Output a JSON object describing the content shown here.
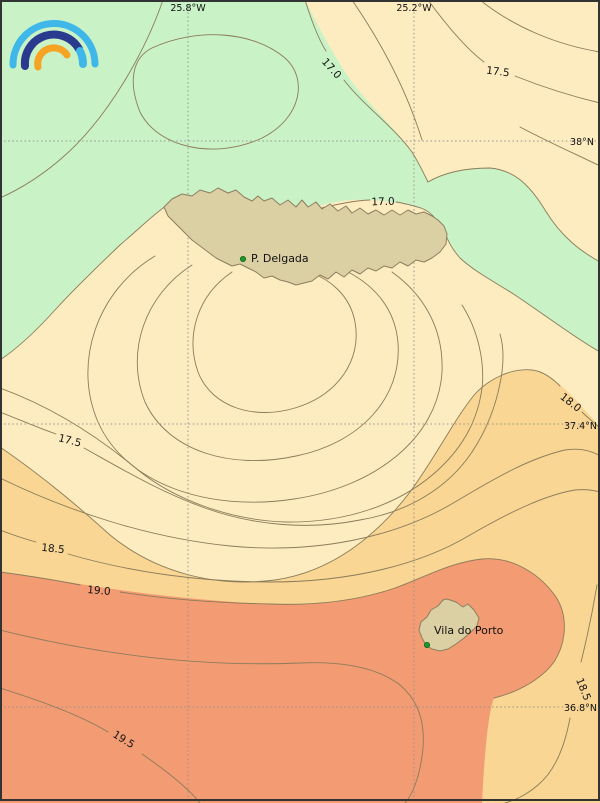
{
  "grid": {
    "lon_labels": [
      "25.8°W",
      "25.2°W"
    ],
    "lat_labels": [
      "38°N",
      "37.4°N",
      "36.8°N"
    ]
  },
  "contour_labels": [
    "17.0",
    "17.0",
    "17.5",
    "17.5",
    "18.0",
    "18.5",
    "18.5",
    "19.0",
    "19.5"
  ],
  "places": {
    "p_delgada": "P. Delgada",
    "vila_do_porto": "Vila do Porto"
  },
  "colors": {
    "band_below_17": "#c9f2c6",
    "band_17_18": "#fdecc0",
    "band_18_19": "#f9d693",
    "band_above_19": "#f39b72",
    "land": "#dbcfa4",
    "contour_line": "#8b7c5a",
    "place_marker": "#1c9a27",
    "logo_light_blue": "#3fb7e8",
    "logo_dark_blue": "#2a3a8f",
    "logo_orange": "#f6a223"
  },
  "chart_data": {
    "type": "heatmap",
    "subtype": "filled-contour-map",
    "labeled_contour_levels": [
      17.0,
      17.5,
      18.0,
      18.5,
      19.0,
      19.5
    ],
    "fill_bands": [
      {
        "range": "< 17.0",
        "color": "#c9f2c6"
      },
      {
        "range": "17.0 - 18.0",
        "color": "#fdecc0"
      },
      {
        "range": "18.0 - 19.0",
        "color": "#f9d693"
      },
      {
        "range": "> 19.0",
        "color": "#f39b72"
      }
    ],
    "graticule": {
      "longitudes": [
        "25.8°W",
        "25.2°W"
      ],
      "latitudes": [
        "38°N",
        "37.4°N",
        "36.8°N"
      ]
    },
    "annotations": [
      "P. Delgada",
      "Vila do Porto"
    ]
  }
}
